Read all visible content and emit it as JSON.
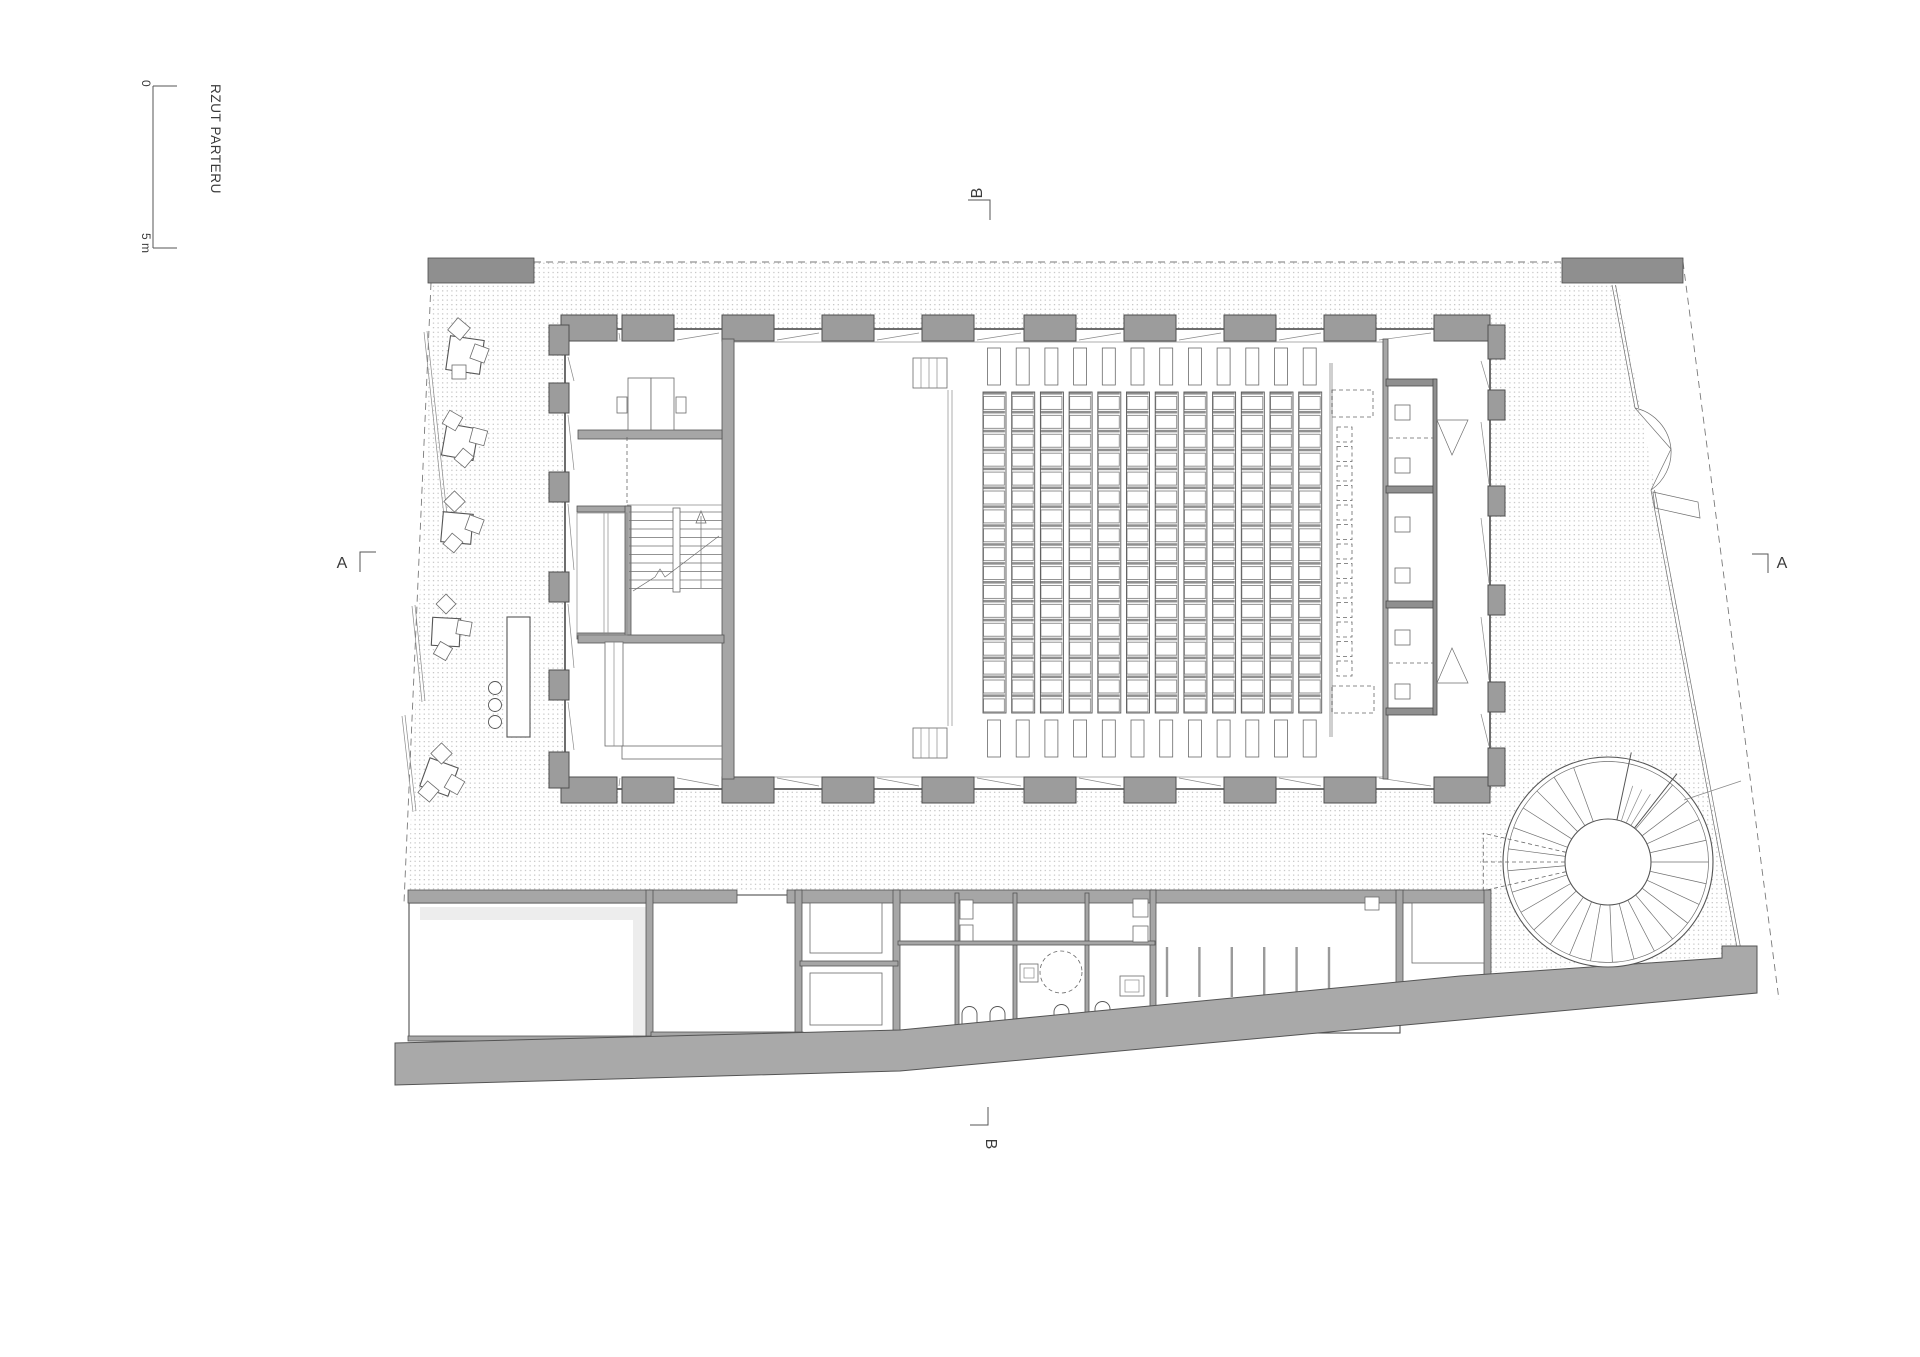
{
  "title": "RZUT PARTERU",
  "scale_bar": {
    "start": "0",
    "end": "5 m"
  },
  "section_markers": {
    "a_left": "A",
    "a_right": "A",
    "b_top": "B",
    "b_bottom": "B"
  },
  "colors": {
    "wall": "#a6a6a6",
    "pilaster": "#9c9c9c",
    "walkway": "#a9a9a9",
    "line": "#555555",
    "plaza_dot": "#bdbdbd",
    "background": "#ffffff"
  }
}
